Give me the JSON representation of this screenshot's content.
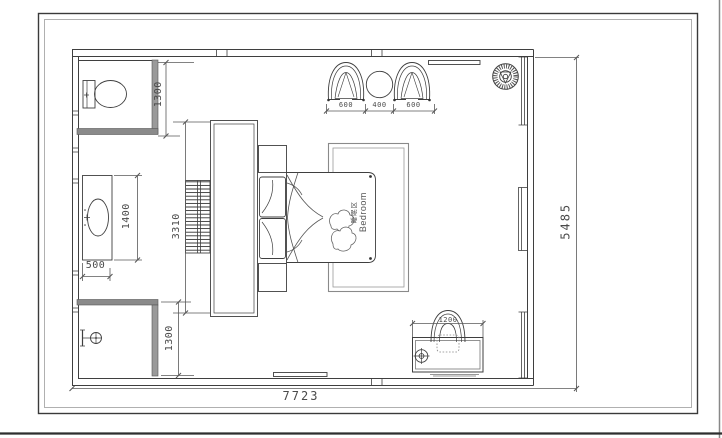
{
  "room_label": {
    "zh": "睡眠区",
    "en": "Bedroom"
  },
  "dimensions": {
    "toilet_area_depth": "1300",
    "vanity_length": "1400",
    "vanity_width": "500",
    "headboard_wall_length": "3310",
    "shower_area_depth": "1300",
    "armchair_left_width": "600",
    "side_table_width": "400",
    "armchair_right_width": "600",
    "desk_length": "1200",
    "plan_overall_width": "7723",
    "plan_overall_depth": "5485"
  },
  "colors": {
    "ink": "#3f3f3f",
    "dim_text": "#4a4a4a",
    "wall_fill": "#9a9a9a",
    "paper": "#ffffff"
  }
}
